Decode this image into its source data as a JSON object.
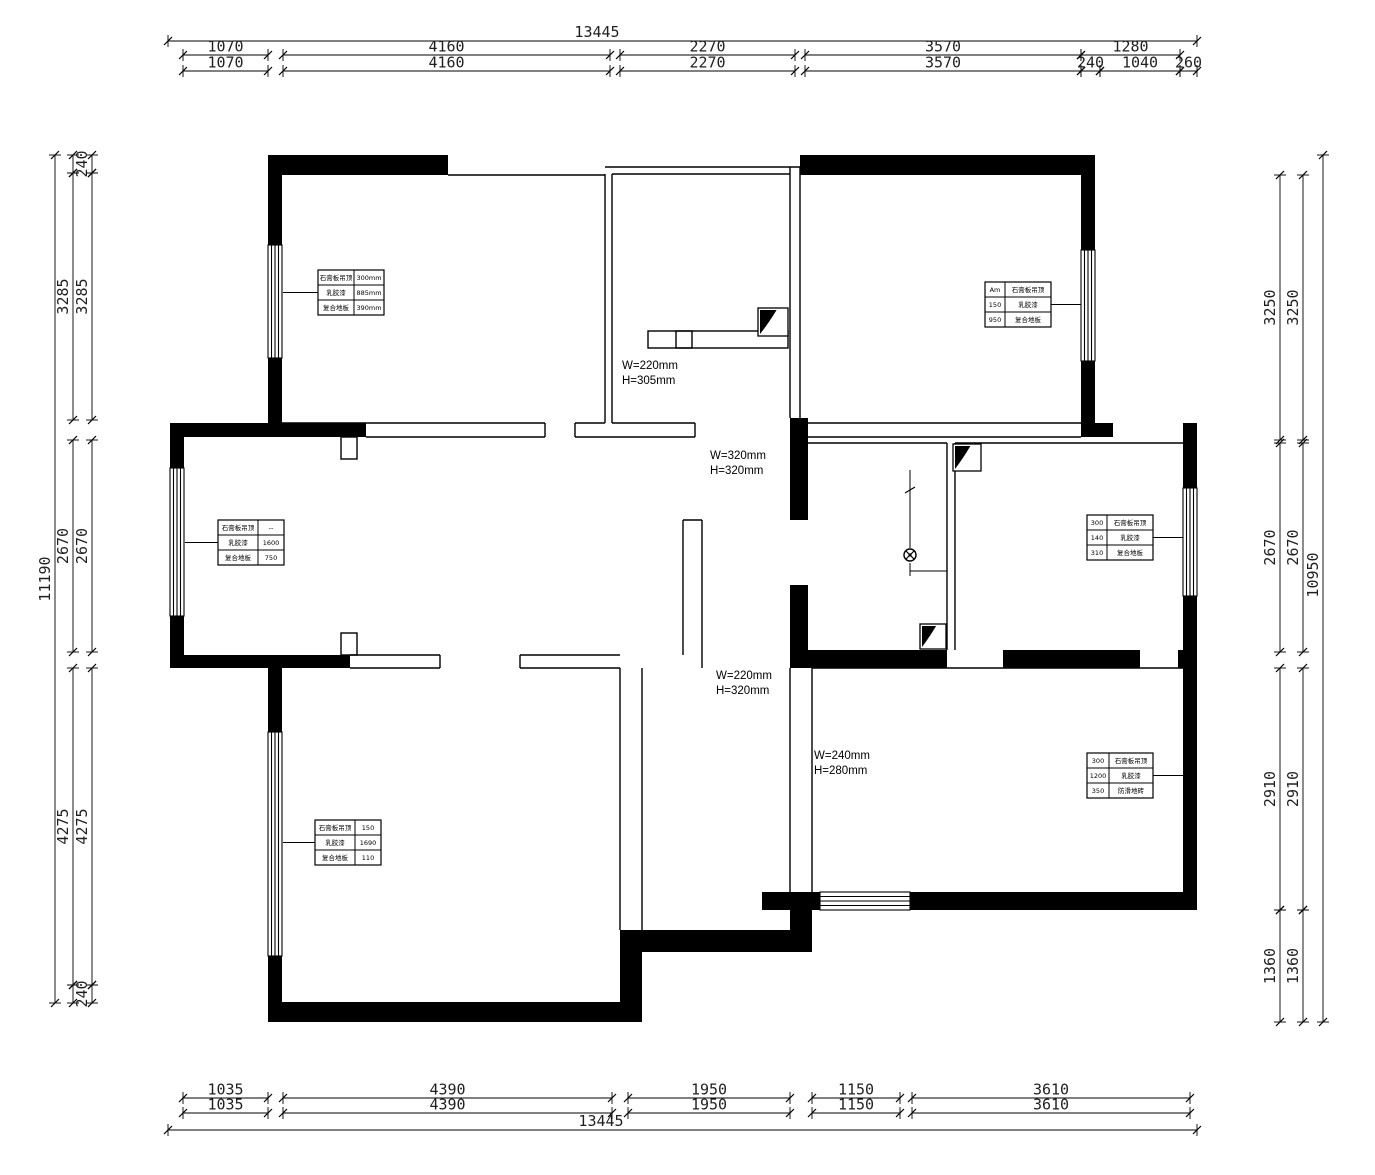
{
  "drawing_title": "apartment floor plan",
  "colors": {
    "ink": "#000000",
    "dim_text": "#1f1f1f",
    "background": "#ffffff"
  },
  "dims": {
    "top": {
      "overall": {
        "label": "13445",
        "y": 41,
        "x1": 168,
        "x2": 1197,
        "cx": 597
      },
      "rows": [
        {
          "y": 55,
          "boxes": [
            {
              "label": "1070",
              "x1": 183,
              "x2": 268
            },
            {
              "label": "4160",
              "x1": 283,
              "x2": 610
            },
            {
              "label": "2270",
              "x1": 620,
              "x2": 795
            },
            {
              "label": "3570",
              "x1": 805,
              "x2": 1081
            },
            {
              "label": "1280",
              "x1": 1081,
              "x2": 1180
            }
          ]
        },
        {
          "y": 71,
          "boxes": [
            {
              "label": "1070",
              "x1": 183,
              "x2": 268
            },
            {
              "label": "4160",
              "x1": 283,
              "x2": 610
            },
            {
              "label": "2270",
              "x1": 620,
              "x2": 795
            },
            {
              "label": "3570",
              "x1": 805,
              "x2": 1081
            },
            {
              "label": "240",
              "x1": 1081,
              "x2": 1100
            },
            {
              "label": "1040",
              "x1": 1100,
              "x2": 1180
            },
            {
              "label": "260",
              "x1": 1180,
              "x2": 1197
            }
          ]
        }
      ]
    },
    "bottom": {
      "overall": {
        "label": "13445",
        "y": 1130,
        "x1": 168,
        "x2": 1197,
        "cx": 601
      },
      "rows": [
        {
          "y": 1098,
          "boxes": [
            {
              "label": "1035",
              "x1": 183,
              "x2": 268
            },
            {
              "label": "4390",
              "x1": 283,
              "x2": 612
            },
            {
              "label": "1950",
              "x1": 628,
              "x2": 790
            },
            {
              "label": "1150",
              "x1": 812,
              "x2": 900
            },
            {
              "label": "3610",
              "x1": 912,
              "x2": 1190
            }
          ]
        },
        {
          "y": 1113,
          "boxes": [
            {
              "label": "1035",
              "x1": 183,
              "x2": 268
            },
            {
              "label": "4390",
              "x1": 283,
              "x2": 612
            },
            {
              "label": "1950",
              "x1": 628,
              "x2": 790
            },
            {
              "label": "1150",
              "x1": 812,
              "x2": 900
            },
            {
              "label": "3610",
              "x1": 912,
              "x2": 1190
            }
          ]
        }
      ]
    },
    "left": {
      "overall": {
        "label": "11190",
        "x": 55,
        "y1": 155,
        "y2": 1003,
        "cy": 579
      },
      "rows": [
        {
          "x": 73,
          "boxes": [
            {
              "y1": 155,
              "y2": 173
            },
            {
              "label": "3285",
              "y1": 173,
              "y2": 420
            },
            {
              "label": "2670",
              "y1": 440,
              "y2": 652
            },
            {
              "label": "4275",
              "y1": 668,
              "y2": 985
            },
            {
              "y1": 985,
              "y2": 1003
            }
          ]
        },
        {
          "x": 92,
          "boxes": [
            {
              "label": "240",
              "y1": 155,
              "y2": 173
            },
            {
              "label": "3285",
              "y1": 173,
              "y2": 420
            },
            {
              "label": "2670",
              "y1": 440,
              "y2": 652
            },
            {
              "label": "4275",
              "y1": 668,
              "y2": 985
            },
            {
              "label": "240",
              "y1": 985,
              "y2": 1003
            }
          ]
        }
      ]
    },
    "right": {
      "overall": {
        "label": "10950",
        "x": 1323,
        "y1": 155,
        "y2": 1022,
        "cy": 575
      },
      "rows": [
        {
          "x": 1280,
          "boxes": [
            {
              "label": "3250",
              "y1": 175,
              "y2": 440
            },
            {
              "label": "2670",
              "y1": 443,
              "y2": 652
            },
            {
              "label": "2910",
              "y1": 668,
              "y2": 910
            },
            {
              "label": "1360",
              "y1": 910,
              "y2": 1022
            }
          ]
        },
        {
          "x": 1303,
          "boxes": [
            {
              "label": "3250",
              "y1": 175,
              "y2": 440
            },
            {
              "label": "2670",
              "y1": 443,
              "y2": 652
            },
            {
              "label": "2910",
              "y1": 668,
              "y2": 910
            },
            {
              "label": "1360",
              "y1": 910,
              "y2": 1022
            }
          ]
        }
      ]
    }
  },
  "annotations": [
    {
      "x": 622,
      "y": 369,
      "line1": "W=220mm",
      "line2": "H=305mm"
    },
    {
      "x": 710,
      "y": 459,
      "line1": "W=320mm",
      "line2": "H=320mm"
    },
    {
      "x": 716,
      "y": 679,
      "line1": "W=220mm",
      "line2": "H=320mm"
    },
    {
      "x": 814,
      "y": 759,
      "line1": "W=240mm",
      "line2": "H=280mm"
    }
  ],
  "finish_tables": [
    {
      "x": 318,
      "y": 270,
      "split": 36,
      "side": "left",
      "lx": 283,
      "rows": [
        [
          "石膏板吊顶",
          "300mm"
        ],
        [
          "乳胶漆",
          "885mm"
        ],
        [
          "复合地板",
          "390mm"
        ]
      ]
    },
    {
      "x": 985,
      "y": 282,
      "split": 20,
      "side": "right",
      "lx": 1081,
      "rows": [
        [
          "Am",
          "石膏板吊顶"
        ],
        [
          "150",
          "乳胶漆"
        ],
        [
          "950",
          "复合地板"
        ]
      ]
    },
    {
      "x": 218,
      "y": 520,
      "split": 40,
      "side": "left",
      "lx": 185,
      "rows": [
        [
          "石膏板吊顶",
          "--"
        ],
        [
          "乳胶漆",
          "1600"
        ],
        [
          "复合地板",
          "750"
        ]
      ]
    },
    {
      "x": 1087,
      "y": 515,
      "split": 20,
      "side": "right",
      "lx": 1183,
      "rows": [
        [
          "300",
          "石膏板吊顶"
        ],
        [
          "140",
          "乳胶漆"
        ],
        [
          "310",
          "复合地板"
        ]
      ]
    },
    {
      "x": 315,
      "y": 820,
      "split": 40,
      "side": "left",
      "lx": 283,
      "rows": [
        [
          "石膏板吊顶",
          "150"
        ],
        [
          "乳胶漆",
          "1690"
        ],
        [
          "复合地板",
          "110"
        ]
      ]
    },
    {
      "x": 1087,
      "y": 753,
      "split": 22,
      "side": "right",
      "lx": 1183,
      "rows": [
        [
          "300",
          "石膏板吊顶"
        ],
        [
          "1200",
          "乳胶漆"
        ],
        [
          "350",
          "防滑地砖"
        ]
      ]
    }
  ],
  "shaft_symbols": [
    {
      "x": 758,
      "y": 308,
      "w": 30,
      "h": 28
    },
    {
      "x": 953,
      "y": 444,
      "w": 28,
      "h": 27
    },
    {
      "x": 920,
      "y": 624,
      "w": 26,
      "h": 25
    }
  ],
  "light_symbol": {
    "cx": 910,
    "cy": 555,
    "r": 6,
    "stem_y": 470,
    "tick_x": 947
  }
}
